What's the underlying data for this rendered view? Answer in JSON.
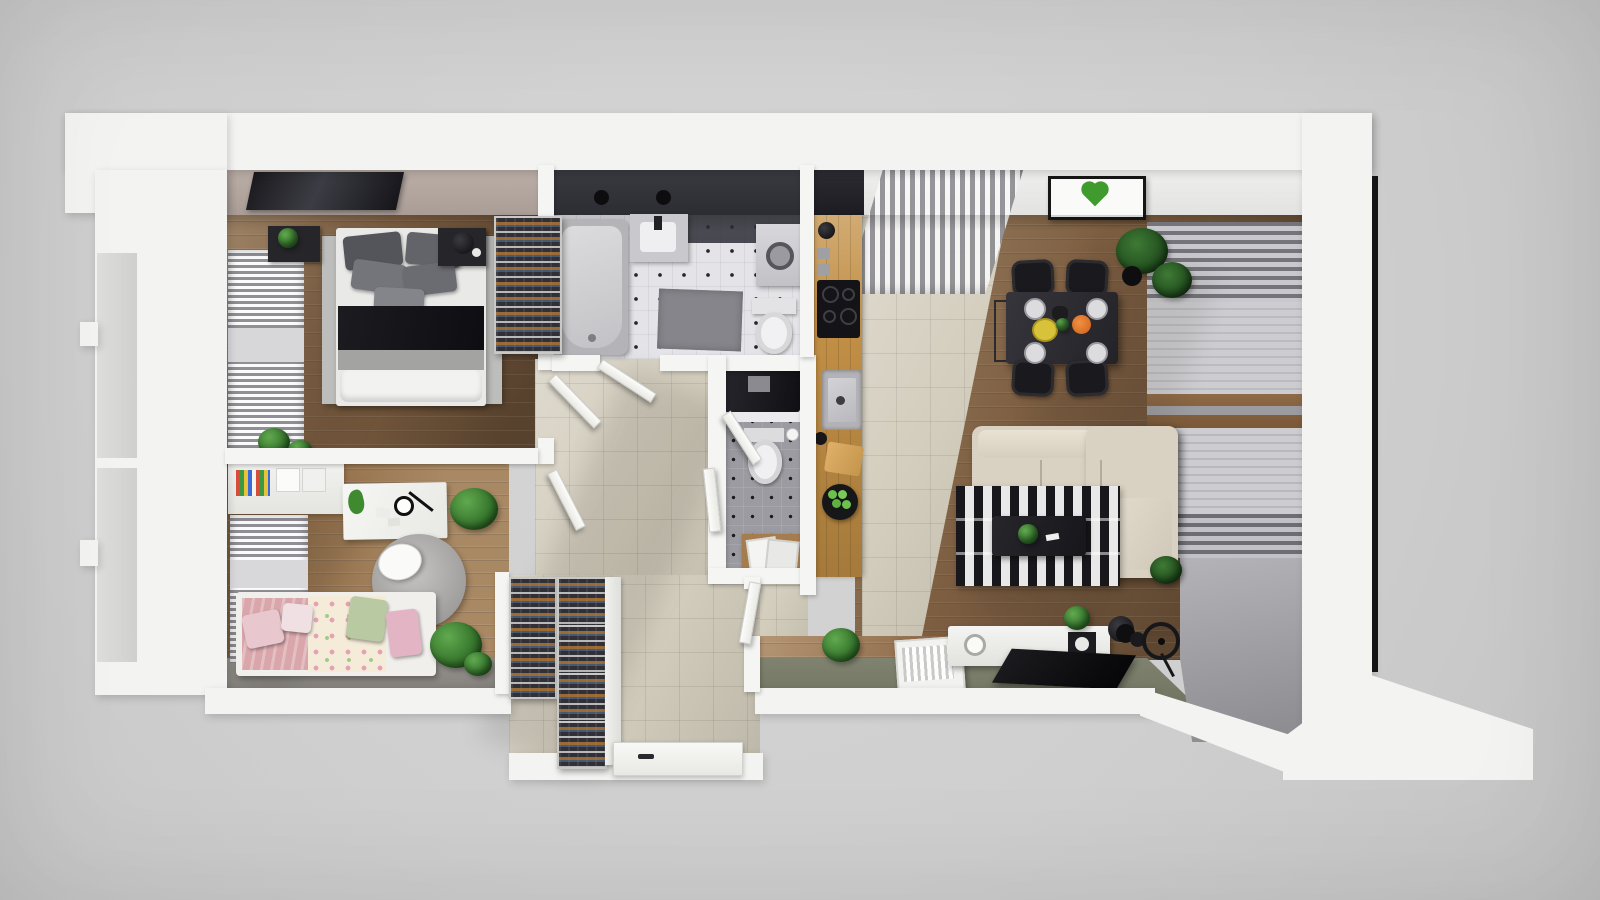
{
  "scene": {
    "type": "3d-dollhouse-floorplan-render",
    "visible_text": "none",
    "background_color": "#cfcfcf",
    "outer_wall_color": "#f3f3f1",
    "palette": {
      "wood_floor": "#7d5e41",
      "wood_floor_light": "#96734e",
      "bath_tile": "#e4e4e8",
      "wc_tile": "#9b9ba1",
      "hall_tile": "#d3cdbd",
      "kitchen_counter": "#c28f45",
      "balcony_floor_olive": "#7b7e6c",
      "sofa_beige": "#d9d2c3",
      "rug_stripe_dark": "#18181c",
      "rug_stripe_light": "#e8e8e8",
      "accent_moss_green": "#3f9b2e",
      "kids_pink": "#d9a6ab",
      "kids_green_pillow": "#b9c9a2"
    },
    "rooms": [
      {
        "name": "bedroom",
        "floor": "wood",
        "items": [
          "double-bed",
          "gray-pillows",
          "black-throw",
          "area-rug",
          "nightstand-left-with-plant",
          "nightstand-right-with-lamp",
          "wall-tv",
          "window-radiator-blinds",
          "wine-rack",
          "plants",
          "black-desk"
        ]
      },
      {
        "name": "bathroom",
        "floor": "white-tile-black-dots",
        "items": [
          "bathtub",
          "wash-basin",
          "shower-heads",
          "washing-machine",
          "toilet",
          "gray-mat",
          "dark-tiled-wall"
        ]
      },
      {
        "name": "wc",
        "floor": "gray-tile-black-dots",
        "items": [
          "black-vanity-counter",
          "toilet",
          "wood-cabinet",
          "picture-frames"
        ]
      },
      {
        "name": "kitchen",
        "floor": "beige-tile",
        "items": [
          "wood-counter",
          "fridge",
          "kettle",
          "wall-sockets",
          "induction-cooktop",
          "sink",
          "ladle",
          "cutting-board",
          "bowl-of-green-apples"
        ]
      },
      {
        "name": "living-dining-room",
        "floor": "wood",
        "items": [
          "dining-table",
          "four-black-chairs",
          "place-settings",
          "yellow-plate",
          "orange-dish",
          "corner-plant",
          "vertical-blinds",
          "moss-heart-wall-art",
          "corner-sofa-beige",
          "striped-rug",
          "coffee-table-with-plant",
          "roller-blinds-window",
          "tv-sideboard",
          "speaker",
          "record-player",
          "book-crate",
          "flat-tv",
          "exercise-wheel",
          "dumbbells",
          "stool",
          "plants"
        ]
      },
      {
        "name": "kids-room",
        "floor": "wood-light",
        "items": [
          "wall-shelves-with-books",
          "white-desk",
          "toy-dinosaur",
          "desk-lamp",
          "papers",
          "round-rug",
          "white-chair",
          "single-bed",
          "pink-blanket",
          "floral-blanket",
          "pillows",
          "window-radiator-blinds",
          "plants"
        ]
      },
      {
        "name": "hallway",
        "floor": "beige-tile",
        "items": [
          "interior-door-leaves"
        ]
      },
      {
        "name": "entry",
        "floor": "beige-tile",
        "items": [
          "shoe-rack-column-1",
          "shoe-rack-column-2",
          "white-cabinet-panel",
          "front-door-with-handle"
        ]
      }
    ]
  }
}
